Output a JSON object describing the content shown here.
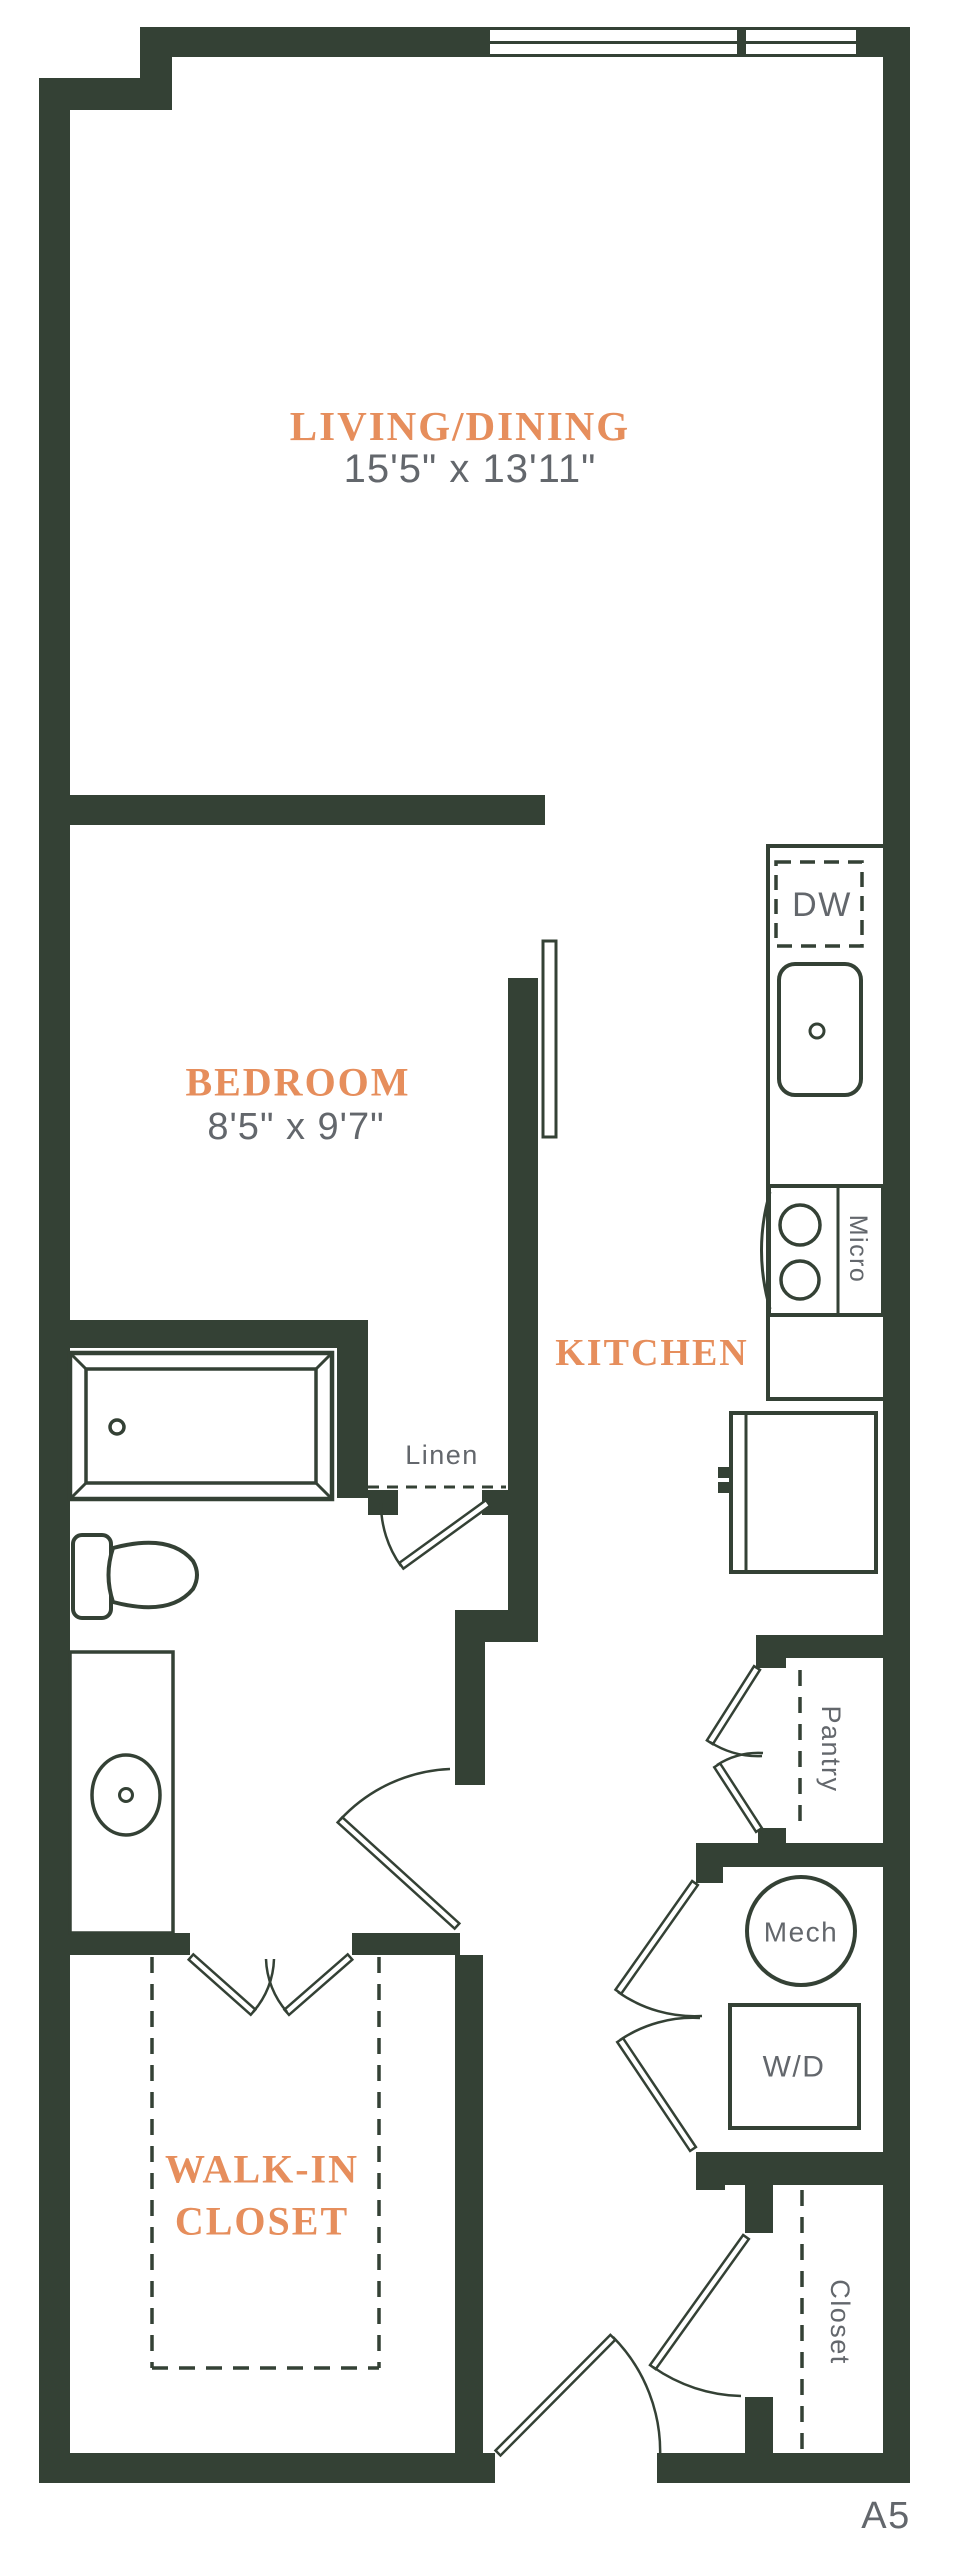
{
  "plan": {
    "code": "A5",
    "colors": {
      "wall": "#344135",
      "accent": "#e68e5c",
      "text_gray": "#63676c"
    },
    "rooms": {
      "living_dining": {
        "label": "LIVING/DINING",
        "dimensions": "15'5\" x 13'11\""
      },
      "bedroom": {
        "label": "BEDROOM",
        "dimensions": "8'5\" x 9'7\""
      },
      "kitchen": {
        "label": "KITCHEN"
      },
      "walk_in_closet": {
        "label_line1": "WALK-IN",
        "label_line2": "CLOSET"
      }
    },
    "features": {
      "linen": "Linen",
      "pantry": "Pantry",
      "mech": "Mech",
      "washer_dryer": "W/D",
      "dishwasher": "DW",
      "microwave": "Micro",
      "closet": "Closet"
    }
  }
}
